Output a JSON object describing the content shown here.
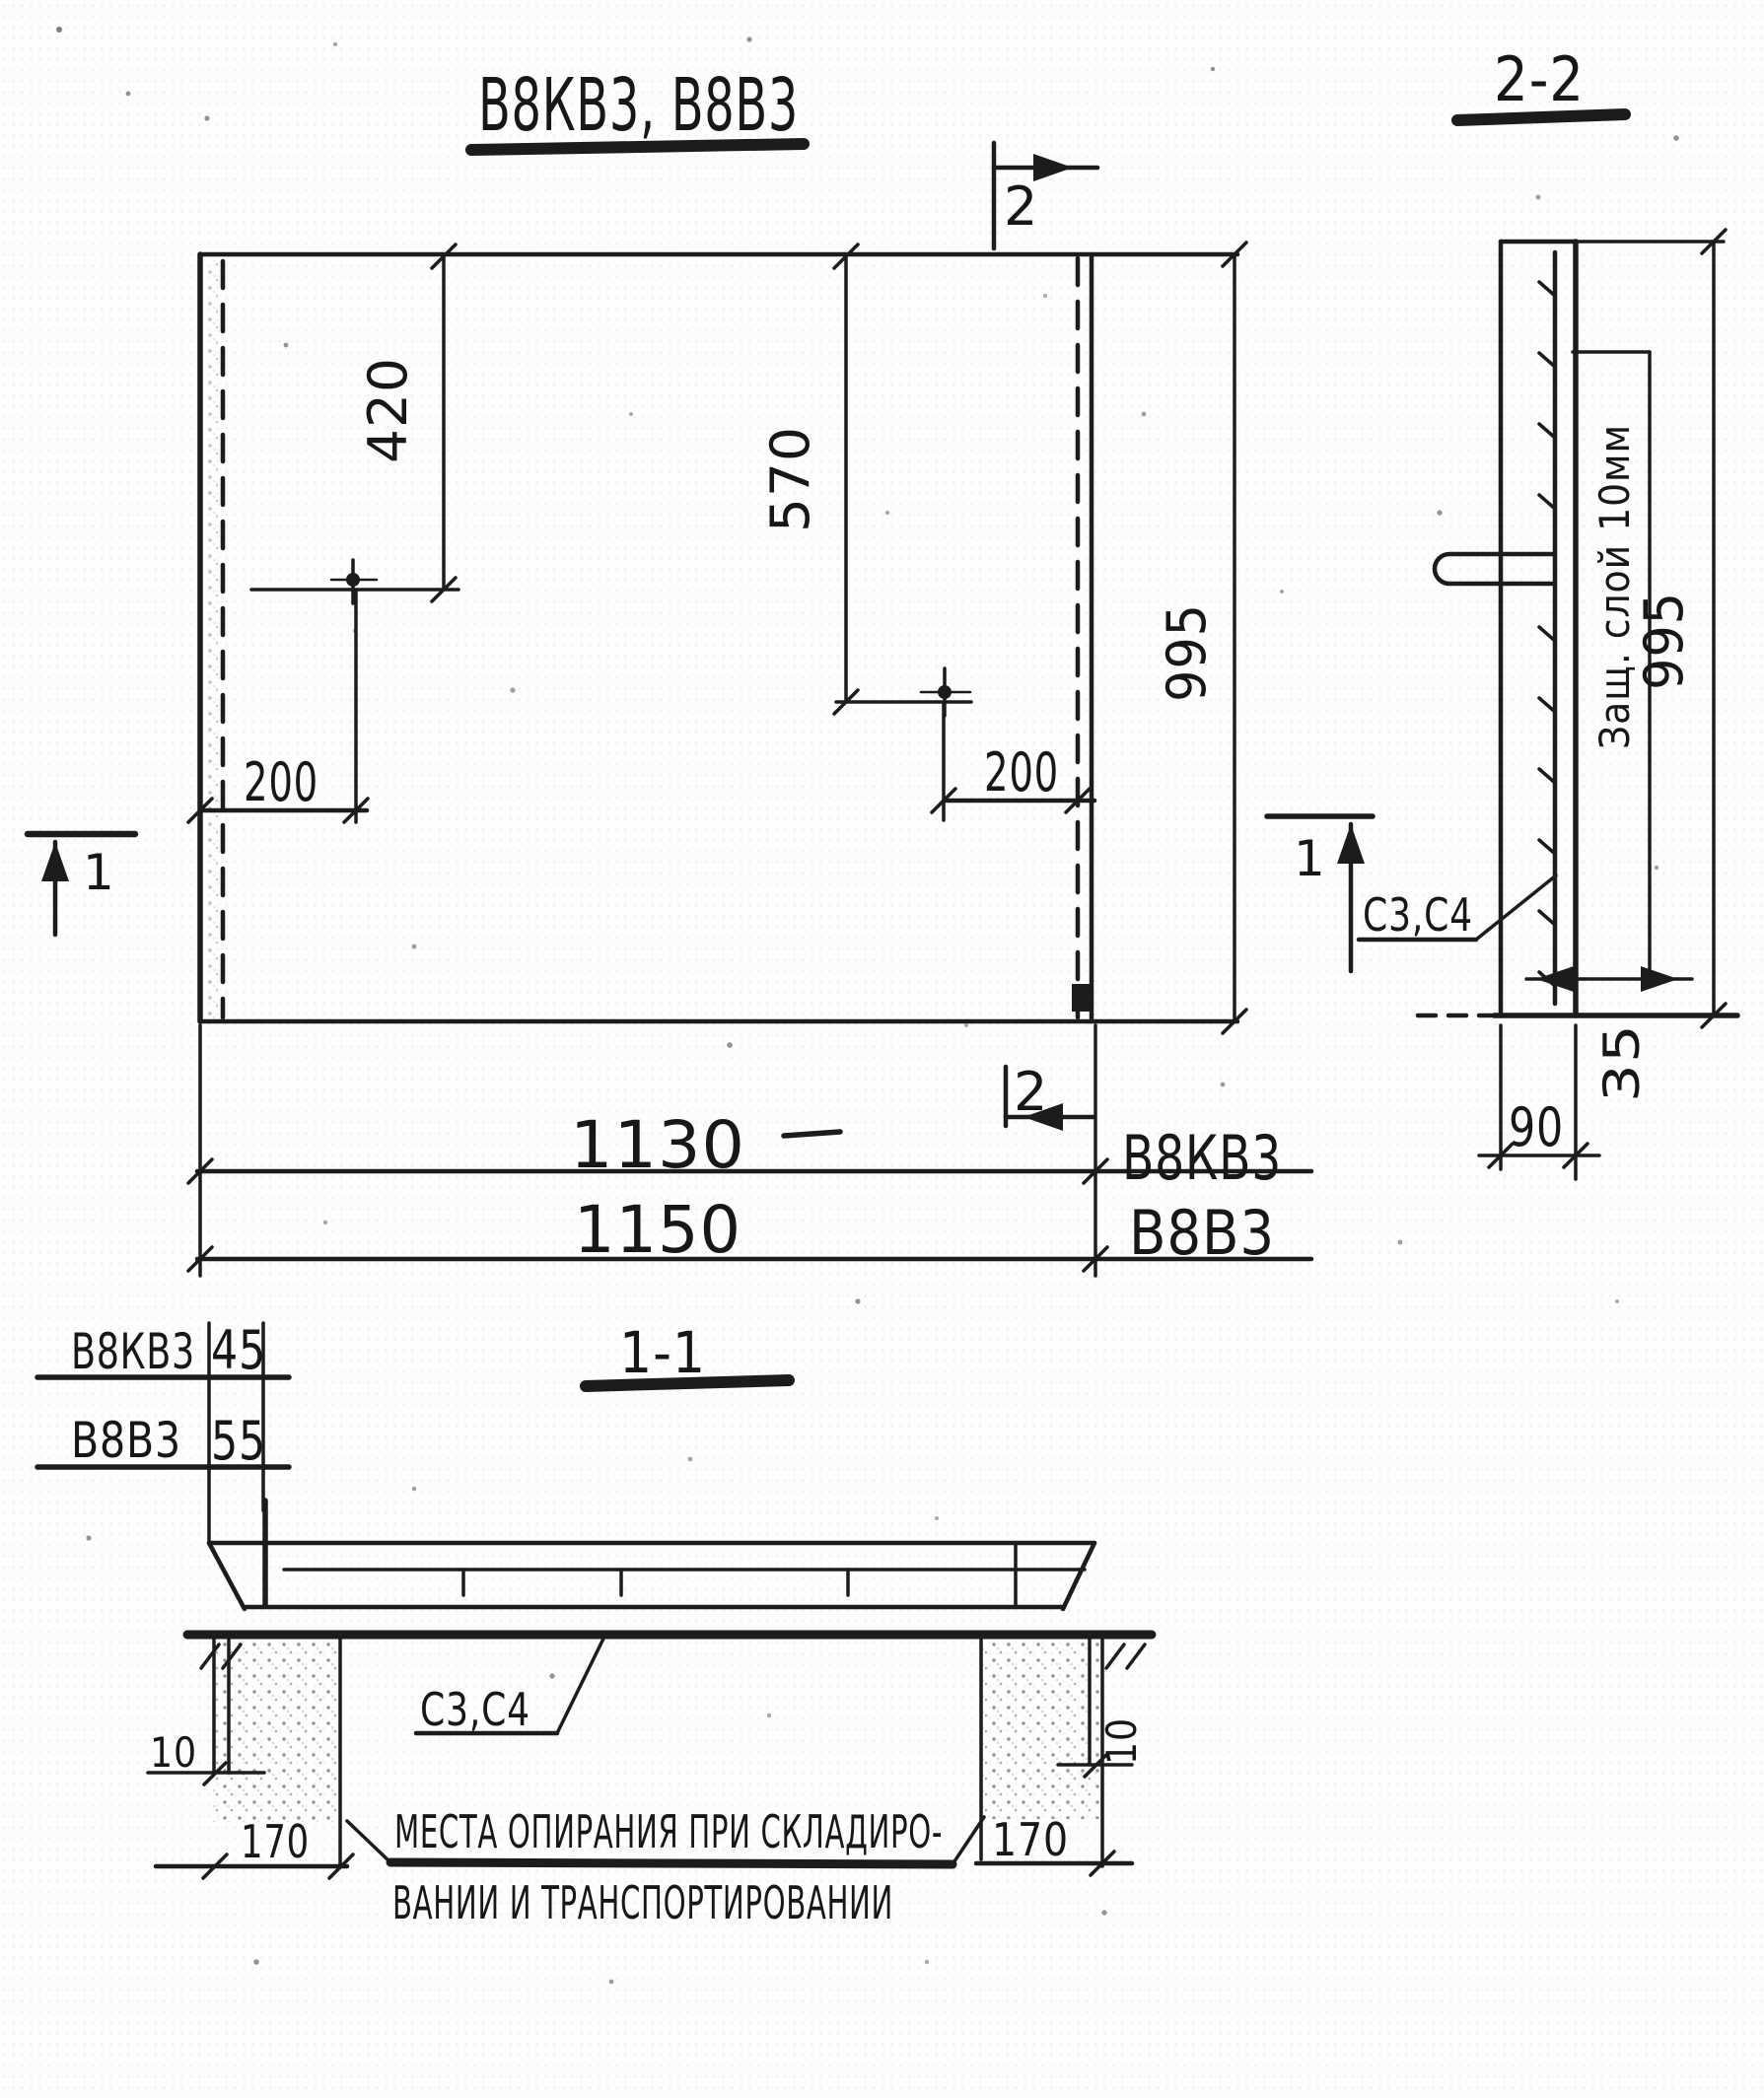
{
  "drawing": {
    "title": "В8КВ3, В8В3",
    "plan": {
      "dim_420": "420",
      "dim_570": "570",
      "dim_995": "995",
      "dim_200_left": "200",
      "dim_200_right": "200",
      "dim_1130": "1130",
      "dim_1150": "1150",
      "label_1130_type": "В8КВ3",
      "label_1150_type": "В8В3",
      "marker_2": "2",
      "marker_1": "1"
    },
    "section_2_2": {
      "label": "2-2",
      "protective_layer_note": "Защ. слой 10мм",
      "dim_995": "995",
      "dim_35": "35",
      "dim_90": "90",
      "rebar_label": "С3,С4"
    },
    "section_1_1": {
      "label": "1-1",
      "thickness": [
        {
          "type": "В8КВ3",
          "value": "45"
        },
        {
          "type": "В8В3",
          "value": "55"
        }
      ],
      "rebar_label": "С3,С4",
      "dim_10_left": "10",
      "dim_10_right": "10",
      "dim_170_left": "170",
      "dim_170_right": "170",
      "note_line1": "МЕСТА ОПИРАНИЯ ПРИ СКЛАДИРО-",
      "note_line2": "ВАНИИ И ТРАНСПОРТИРОВАНИИ"
    }
  }
}
